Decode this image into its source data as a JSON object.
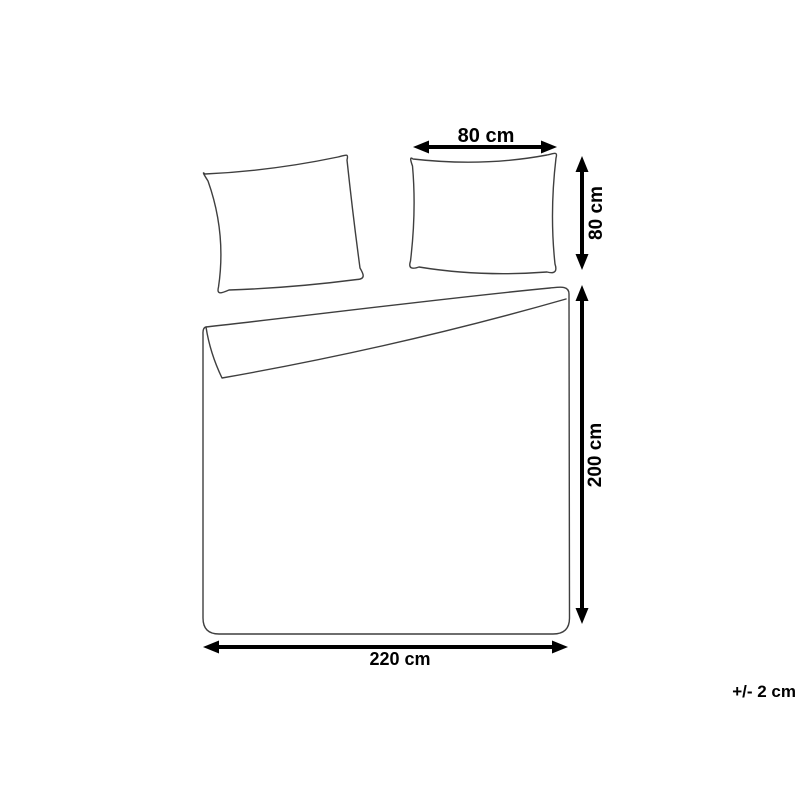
{
  "diagram": {
    "labels": {
      "pillow_width": "80 cm",
      "pillow_height": "80 cm",
      "duvet_length": "200 cm",
      "duvet_width": "220 cm",
      "tolerance": "+/- 2 cm"
    },
    "colors": {
      "background": "#ffffff",
      "outline": "#3f3f3f",
      "dimension": "#000000"
    }
  }
}
